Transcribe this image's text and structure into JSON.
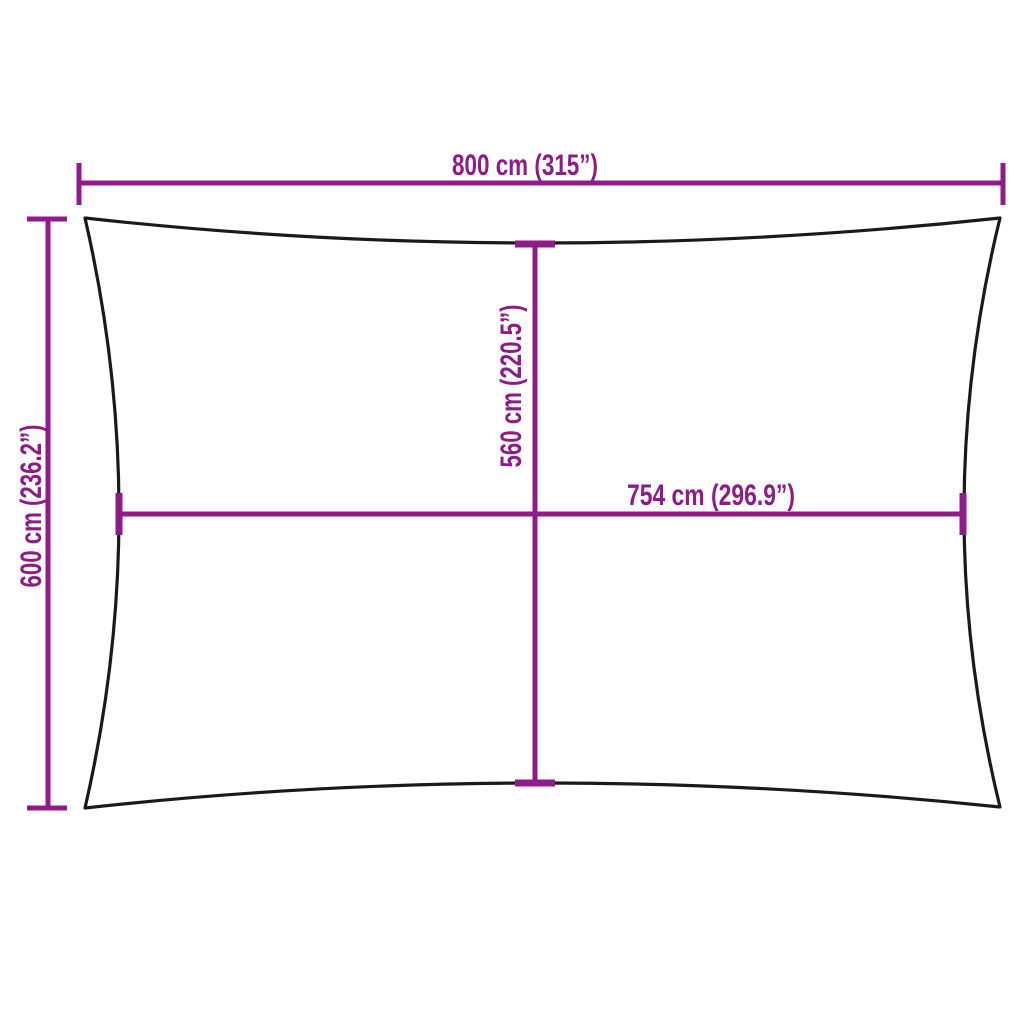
{
  "diagram": {
    "labels": {
      "top_width": "800 cm (315”)",
      "left_height": "600 cm (236.2”)",
      "center_height": "560 cm (220.5”)",
      "center_width": "754 cm (296.9”)"
    }
  },
  "colors": {
    "dimension": "#8F1B88",
    "outline": "#1A1A1A",
    "background": "#FFFFFF"
  }
}
